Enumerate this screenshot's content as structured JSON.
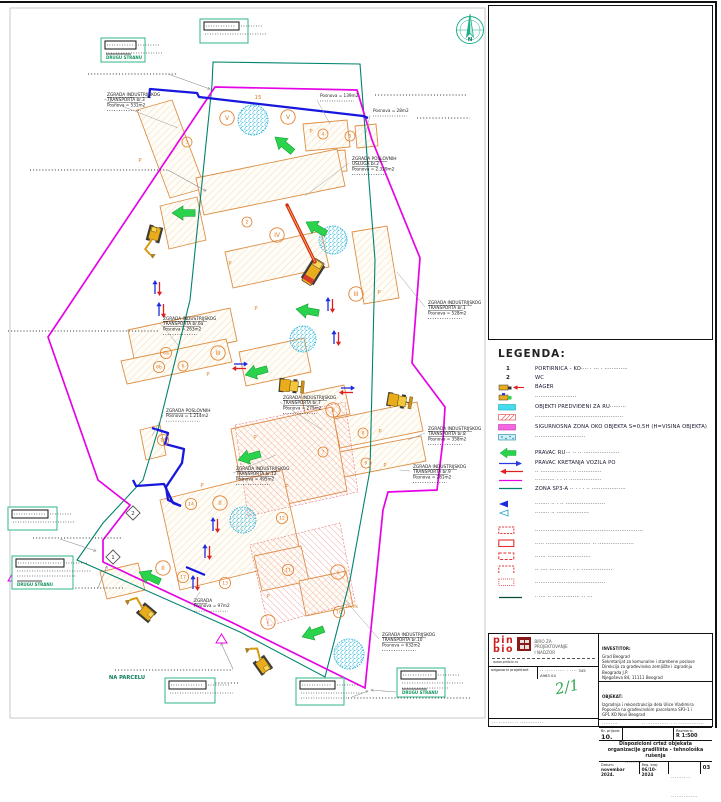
{
  "colors": {
    "magenta": "#E504E5",
    "teal": "#00836E",
    "blue": "#1717DD",
    "orange": "#DD8F45",
    "cyan": "#2AB4D8",
    "green": "#2BD24B",
    "red": "#E02020",
    "legend_box_green": "#3FBD8F"
  },
  "map": {
    "compass_label": "N",
    "na_parcelu": "NA PARCELU",
    "p_plus": "P+Pk",
    "marker_15": "15",
    "p_mark": "P",
    "labels": [
      {
        "x": 107,
        "y": 96,
        "title": [
          "ZGRADA INDUSTRIJSKOG",
          "TRANSPORTA  br.3"
        ],
        "area": "Posnova = 531m2",
        "tx": 178,
        "ty": 128
      },
      {
        "x": 320,
        "y": 97,
        "title": [],
        "area": "Posnova = 139m2",
        "tx": 330,
        "ty": 124
      },
      {
        "x": 373,
        "y": 112,
        "title": [],
        "area": "Posnova = 28m2",
        "tx": 366,
        "ty": 133
      },
      {
        "x": 352,
        "y": 160,
        "title": [
          "ZGRADA POSLOVNIH",
          "USLUGA  br.2"
        ],
        "area": "Posnova = 2.329m2",
        "tx": 305,
        "ty": 196
      },
      {
        "x": 428,
        "y": 304,
        "title": [
          "ZGRADA INDUSTRIJSKOG",
          "TRANSPORTA  br.1"
        ],
        "area": "Posnova = 528m2",
        "tx": 397,
        "ty": 272
      },
      {
        "x": 163,
        "y": 320,
        "title": [
          "ZGRADA INDUSTRIJSKOG",
          "TRANSPORTA  br.6a"
        ],
        "area": "Posnova = 263m2",
        "tx": 178,
        "ty": 345
      },
      {
        "x": 166,
        "y": 412,
        "title": [
          "ZGRADA POSLOVNIH"
        ],
        "area": "Posnova = 1.214m2",
        "tx": 152,
        "ty": 436
      },
      {
        "x": 283,
        "y": 399,
        "title": [
          "ZGRADA INDUSTRIJSKOG",
          "TRANSPORTA  br.7"
        ],
        "area": "Posnova = 275m2",
        "tx": 322,
        "ty": 430
      },
      {
        "x": 236,
        "y": 470,
        "title": [
          "ZGRADA INDUSTRIJSKOG",
          "TRANSPORTA  br.12"
        ],
        "area": "Posnova = 495m2",
        "tx": 276,
        "ty": 455
      },
      {
        "x": 428,
        "y": 430,
        "title": [
          "ZGRADA INDUSTRIJSKOG",
          "TRANSPORTA  br.8"
        ],
        "area": "Posnova = 358m2",
        "tx": 408,
        "ty": 440
      },
      {
        "x": 413,
        "y": 468,
        "title": [
          "ZGRADA INDUSTRIJSKOG",
          "TRANSPORTA  br.9"
        ],
        "area": "Posnova = 281m2",
        "tx": 400,
        "ty": 470
      },
      {
        "x": 194,
        "y": 602,
        "title": [
          "ZGRADA"
        ],
        "area": "Posnova = 97m2",
        "tx": 200,
        "ty": 592
      },
      {
        "x": 382,
        "y": 636,
        "title": [
          "ZGRADA INDUSTRIJSKOG",
          "TRANSPORTA  br.10"
        ],
        "area": "Posnova = 632m2",
        "tx": 345,
        "ty": 600
      }
    ],
    "callouts": [
      {
        "x": 101,
        "y": 38,
        "w": 44,
        "h": 24,
        "text": "DRUGU STRANU"
      },
      {
        "x": 200,
        "y": 19,
        "w": 48,
        "h": 24,
        "text": ""
      },
      {
        "x": 8,
        "y": 507,
        "w": 49,
        "h": 23,
        "text": ""
      },
      {
        "x": 12,
        "y": 556,
        "w": 61,
        "h": 33,
        "text": "DRUGU STRANU"
      },
      {
        "x": 165,
        "y": 678,
        "w": 50,
        "h": 25,
        "text": ""
      },
      {
        "x": 296,
        "y": 678,
        "w": 48,
        "h": 27,
        "text": ""
      },
      {
        "x": 397,
        "y": 668,
        "w": 48,
        "h": 29,
        "text": "DRUGU STRANU"
      }
    ],
    "geometry": {
      "site_boundary": "215,87 357,90 372,140 420,258 412,363 445,407 443,440 437,490 388,492 383,510 365,688 233,623 103,562 103,540 130,505 98,480 48,337",
      "zone_sp3": "213,62 360,64 375,260 370,470 350,580 325,677 240,632 100,570 77,560 103,523 143,480 158,430 190,300 212,85",
      "blue_lines": [
        "149,98 150,89 197,93 199,97 363,116 368,118",
        "152,428 168,433 165,444 184,449 182,463 166,487 168,500 181,506",
        "133,480 136,486 164,484 173,503 181,506",
        "186,567 205,575"
      ],
      "buildings": [
        "137,110 172,100 205,188 170,198",
        "303,124 347,120 350,147 306,151",
        "330,151 345,150 347,171 332,172",
        "355,126 376,124 378,146 357,148",
        "196,178 337,149 345,186 204,215",
        "160,206 197,197 206,240 169,249",
        "225,252 321,231 329,267 233,288",
        "352,232 387,226 399,298 364,304",
        "128,330 230,308 237,341 135,363",
        "121,361 226,339 232,362 127,384",
        "239,352 304,338 311,372 246,386",
        "301,394 344,385 350,414 307,423",
        "334,419 417,402 423,431 340,448",
        "329,454 421,436 426,461 334,479",
        "231,429 332,407 347,491 246,513",
        "160,500 282,470 302,560 180,590",
        "254,556 301,546 309,581 262,591",
        "299,581 346,571 353,606 306,616",
        "140,430 160,425 166,455 146,460",
        "100,572 138,563 145,590 107,599"
      ],
      "red_hatch": [
        "235,425 345,402 358,492 248,516",
        "250,545 340,523 355,602 268,626"
      ],
      "speckles": [
        [
          253,
          120,
          15
        ],
        [
          333,
          240,
          14
        ],
        [
          303,
          339,
          13
        ],
        [
          243,
          520,
          13
        ],
        [
          349,
          654,
          15
        ]
      ],
      "dot_lines": [
        [
          88,
          74,
          176,
          74
        ],
        [
          375,
          95,
          466,
          95
        ],
        [
          417,
          118,
          470,
          118
        ],
        [
          30,
          170,
          168,
          170
        ],
        [
          8,
          331,
          160,
          331
        ],
        [
          33,
          538,
          122,
          538
        ],
        [
          63,
          588,
          125,
          588
        ],
        [
          115,
          670,
          233,
          670
        ],
        [
          175,
          683,
          240,
          683
        ],
        [
          348,
          698,
          470,
          698
        ]
      ],
      "leaders": [
        [
          168,
          74,
          210,
          89
        ],
        [
          168,
          170,
          206,
          191
        ],
        [
          60,
          539,
          96,
          551
        ],
        [
          98,
          588,
          107,
          566
        ],
        [
          233,
          669,
          221,
          643
        ],
        [
          352,
          697,
          368,
          691
        ],
        [
          396,
          692,
          371,
          690
        ]
      ],
      "green_arrows": [
        [
          172,
          213,
          0
        ],
        [
          275,
          137,
          40
        ],
        [
          306,
          222,
          30
        ],
        [
          296,
          309,
          10
        ],
        [
          245,
          375,
          -15
        ],
        [
          238,
          460,
          -15
        ],
        [
          139,
          572,
          25
        ],
        [
          302,
          637,
          -20
        ]
      ],
      "arrow_pairs": [
        [
          157,
          288,
          0
        ],
        [
          161,
          310,
          0
        ],
        [
          330,
          305,
          0
        ],
        [
          336,
          338,
          0
        ],
        [
          215,
          525,
          0
        ],
        [
          207,
          552,
          0
        ],
        [
          195,
          583,
          0
        ],
        [
          240,
          366,
          90
        ],
        [
          347,
          390,
          90
        ]
      ],
      "machines": [
        {
          "type": "excavator",
          "x": 155,
          "y": 232,
          "rot": -75
        },
        {
          "type": "loader",
          "x": 292,
          "y": 386,
          "rot": 5
        },
        {
          "type": "loader",
          "x": 400,
          "y": 401,
          "rot": 10
        },
        {
          "type": "excavator",
          "x": 148,
          "y": 614,
          "rot": 40
        },
        {
          "type": "excavator",
          "x": 264,
          "y": 667,
          "rot": 55
        }
      ],
      "crane": {
        "x": 313,
        "y": 272,
        "rot": 32,
        "boom": [
          315,
          262,
          287,
          205
        ]
      },
      "diamonds": [
        {
          "x": 133,
          "y": 513,
          "t": "2"
        },
        {
          "x": 113,
          "y": 557,
          "t": "1"
        }
      ],
      "triangles": [
        [
          8,
          572
        ],
        [
          216,
          634
        ]
      ],
      "badges": [
        [
          187,
          142,
          "3"
        ],
        [
          323,
          134,
          "4"
        ],
        [
          350,
          136,
          "5"
        ],
        [
          247,
          222,
          "2"
        ],
        [
          166,
          353,
          "6a"
        ],
        [
          159,
          367,
          "6b"
        ],
        [
          183,
          366,
          "6"
        ],
        [
          323,
          452,
          "7"
        ],
        [
          363,
          433,
          "8"
        ],
        [
          366,
          463,
          "9"
        ],
        [
          339,
          612,
          "10"
        ],
        [
          288,
          570,
          "11"
        ],
        [
          282,
          518,
          "12"
        ],
        [
          225,
          583,
          "13"
        ],
        [
          191,
          504,
          "14"
        ],
        [
          163,
          440,
          "16"
        ],
        [
          183,
          577,
          "17"
        ]
      ],
      "romans": [
        [
          227,
          118,
          "V"
        ],
        [
          288,
          117,
          "V"
        ],
        [
          277,
          235,
          "IV"
        ],
        [
          356,
          294,
          "III"
        ],
        [
          218,
          353,
          "III"
        ],
        [
          333,
          410,
          "II"
        ],
        [
          220,
          503,
          "II"
        ],
        [
          163,
          568,
          "II"
        ],
        [
          338,
          572,
          "I"
        ],
        [
          268,
          622,
          "I"
        ]
      ],
      "p_marks": [
        [
          140,
          162
        ],
        [
          311,
          133
        ],
        [
          208,
          376
        ],
        [
          379,
          294
        ],
        [
          380,
          433
        ],
        [
          385,
          467
        ],
        [
          255,
          439
        ],
        [
          202,
          487
        ],
        [
          287,
          488
        ],
        [
          268,
          598
        ],
        [
          256,
          310
        ],
        [
          230,
          265
        ]
      ]
    }
  },
  "legend": {
    "title": "LEGENDA:",
    "items": [
      {
        "symbol": "text",
        "sym_text": "1",
        "label": "PORTIRNICA - KO····  · ··· · ·············"
      },
      {
        "symbol": "text",
        "sym_text": "2",
        "label": "WC"
      },
      {
        "symbol": "bager",
        "label": "BAGER"
      },
      {
        "symbol": "bager2",
        "label": "·······················"
      },
      {
        "symbol": "swatch-cyan",
        "label": "OBJEKTI PREDVIĐENI ZA RU·········"
      },
      {
        "symbol": "swatch-redhatch",
        "label": "·················································"
      },
      {
        "symbol": "swatch-magenta",
        "label": "SIGURNOSNA ZONA OKO OBJEKTA S=0,5H (H=VISINA OBJEKTA)"
      },
      {
        "symbol": "swatch-cyanhatch",
        "label": "····························"
      },
      {
        "symbol": "arrow-green",
        "label": "PRAVAC RU···  ·· ·· ····················"
      },
      {
        "symbol": "arrow-blue",
        "label": "PRAVAC KRETANJA VOZILA PO"
      },
      {
        "symbol": "arrow-red",
        "label": "·· ··············· · ·· ·············"
      },
      {
        "symbol": "line-magenta",
        "label": "··········· · · ·· ··················"
      },
      {
        "symbol": "line-teal",
        "label": "ZONA SP3-A ··  · · · ·· ···················"
      },
      {
        "symbol": "tri-blue",
        "label": "········ ·· · ·· ······················"
      },
      {
        "symbol": "tri-outline",
        "label": "········ ·· ··················"
      },
      {
        "symbol": "rect-dash1",
        "label": "····························································"
      },
      {
        "symbol": "rect-dash2",
        "label": "·····  ·························  ·· ····················"
      },
      {
        "symbol": "rect-dash3",
        "label": "······ ························"
      },
      {
        "symbol": "rect-dash4",
        "label": "·· ···· ·········· · · ·· ·················"
      },
      {
        "symbol": "rect-dash5",
        "label": "·······································"
      },
      {
        "symbol": "line-dark",
        "label": "· ···· ·· ··············· ·· ···"
      }
    ]
  },
  "titleblock": {
    "logo_top": "pin",
    "logo_bottom": "bio",
    "firm_line1": "BIRO ZA",
    "firm_line2": "PROJEKTOVANJE",
    "firm_line3": "I NADZOR",
    "website": "www.pinbio.rs",
    "role_label": "odgovorni projektant",
    "role_dots": "·· ··········· · ····",
    "licence": "345 A963 04",
    "signature": "2/1",
    "bottom_left_dots": "··· ········ ·· ·············",
    "investor_label": "INVESTITOR:",
    "investor_line1": "Grad Beograd",
    "investor_line2": "Sekretarijat za komunalne i stambene poslove",
    "investor_line3": "Direkcija za građevinsko zemljište i izgradnju Beograda J.P.",
    "investor_line4": "Njegoševa 84, 11111 Beograd",
    "objekat_label": "OBJEKAT:",
    "objekat_line1": "Izgradnja i rekonstrukcija dela Ulice Vladimira",
    "objekat_line2": "Popovića na građevinskim parcelama SP3-1 i",
    "objekat_line3": "GP1  KO Novi Beograd",
    "smallrow_label": "·········",
    "smallrow_dots": "·· ············ · ·· ··············",
    "br_prijave_label": "Br. prijave:",
    "br_prijave": "10.",
    "prijave_dots": "··············· ·· ·········",
    "razmera_label": "Razmera:",
    "razmera": "R 1:500",
    "sheet_title": "Dispozicioni crtež objekata organizacije gradilišta - tehnološka rušenja",
    "datum_label": "Datum:",
    "datum": "novembar 2024.",
    "reg_label": "Reg. broj:",
    "reg": "06/10-2024",
    "bottom_dots": "········ ·· ···············",
    "sheet_no": "03"
  }
}
